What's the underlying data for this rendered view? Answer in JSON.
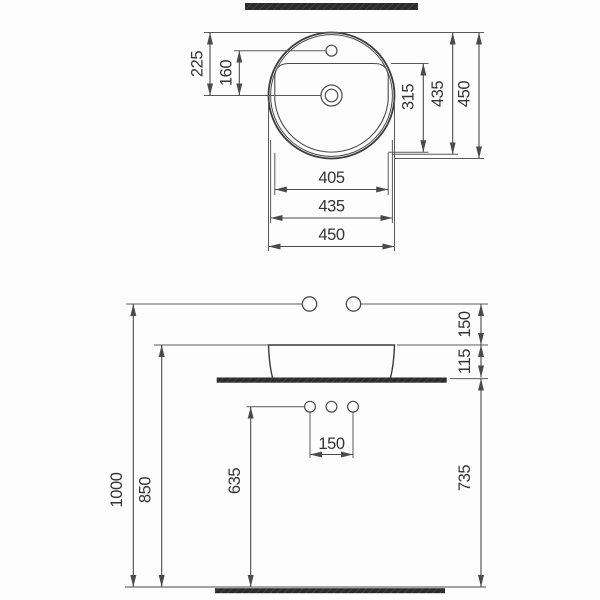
{
  "colors": {
    "line": "#3a3a3a",
    "dimension_line": "#4a4a4a",
    "text": "#333333",
    "bar_fill": "#2c2c2c",
    "bar_hatch": "#4d4d4d",
    "background": "#fdfdfd"
  },
  "top_view": {
    "dim_rim_to_drain": "225",
    "dim_faucet_to_drain": "160",
    "dim_bowl_depth": "315",
    "dim_rim_height": "435",
    "dim_outer_height": "450",
    "dim_bowl_width": "405",
    "dim_rim_width": "435",
    "dim_outer_width": "450"
  },
  "front_view": {
    "dim_supply_height": "1000",
    "dim_rim_level": "850",
    "dim_drain_level": "635",
    "dim_counter_level": "735",
    "dim_supply_above_rim": "150",
    "dim_basin_height": "115",
    "dim_drain_spacing": "150"
  }
}
